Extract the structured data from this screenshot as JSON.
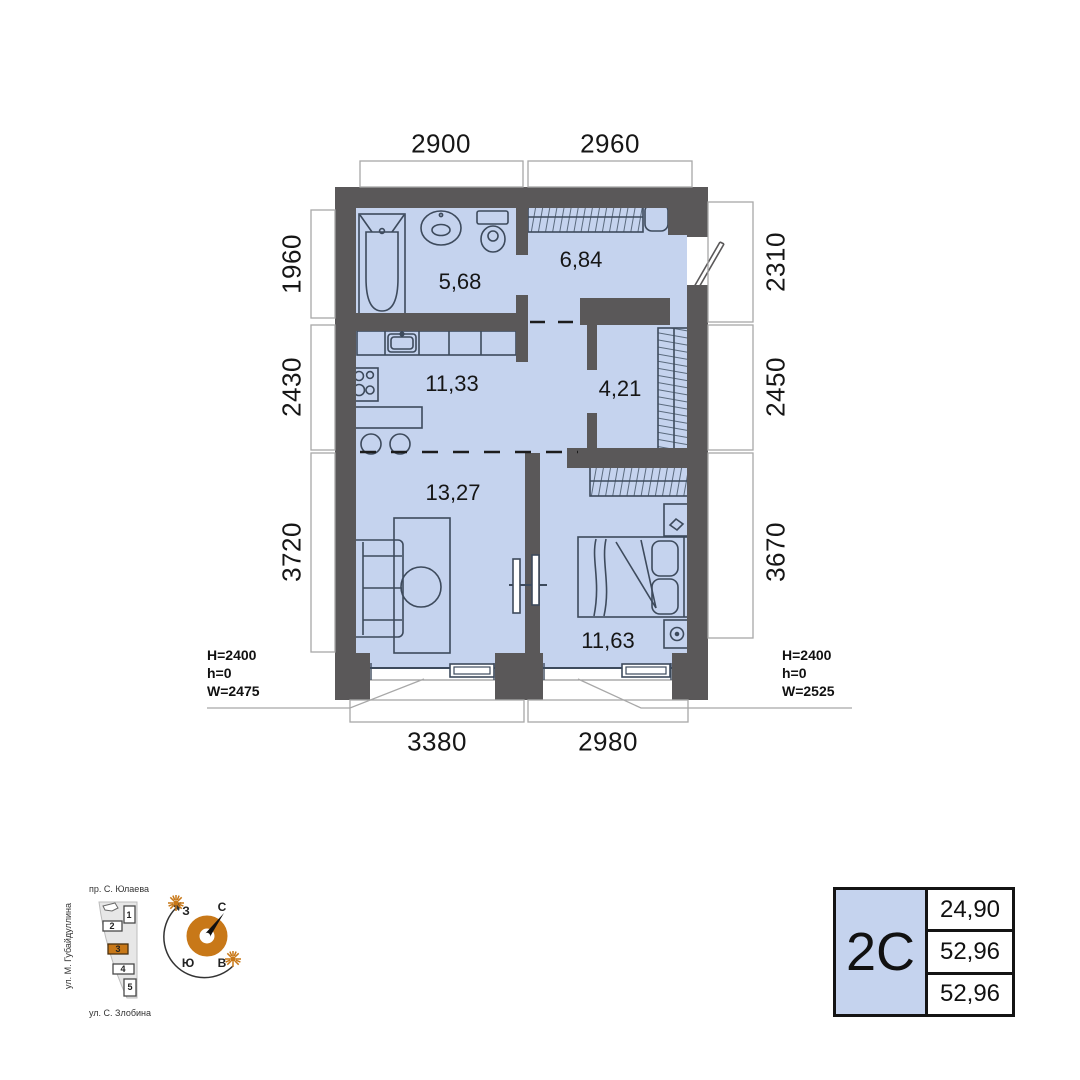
{
  "plan": {
    "dimensions": {
      "top": [
        "2900",
        "2960"
      ],
      "left": [
        "1960",
        "2430",
        "3720"
      ],
      "right": [
        "2310",
        "2450",
        "3670"
      ],
      "bottom": [
        "3380",
        "2980"
      ]
    },
    "rooms": {
      "bathroom": "5,68",
      "hallway": "6,84",
      "kitchen": "11,33",
      "wardrobe": "4,21",
      "living": "13,27",
      "bedroom": "11,63"
    },
    "windows": {
      "left": {
        "height": "H=2400",
        "sill": "h=0",
        "width": "W=2475"
      },
      "right": {
        "height": "H=2400",
        "sill": "h=0",
        "width": "W=2525"
      }
    }
  },
  "site_plan": {
    "street_top": "пр. С. Юлаева",
    "street_left": "ул. М. Губайдуллина",
    "street_bottom": "ул. С. Злобина",
    "buildings": [
      "1",
      "2",
      "3",
      "4",
      "5"
    ],
    "highlighted_building": "3"
  },
  "compass": {
    "north": "С",
    "south": "Ю",
    "west": "З",
    "east": "В"
  },
  "legend": {
    "type": "2С",
    "values": [
      "24,90",
      "52,96",
      "52,96"
    ]
  },
  "colors": {
    "floor": "#c5d3ee",
    "wall": "#5a5859",
    "accent_orange": "#c87818"
  }
}
